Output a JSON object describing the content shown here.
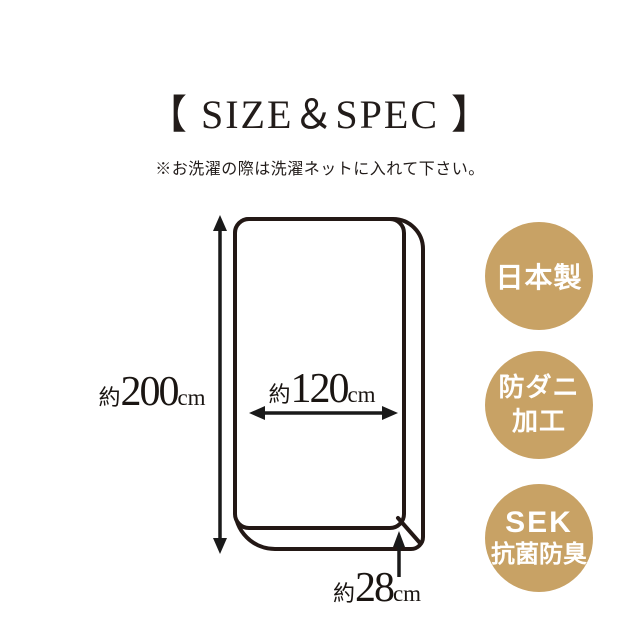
{
  "page": {
    "title": "【 SIZE＆SPEC 】",
    "note": "※お洗濯の際は洗濯ネットに入れて下さい。"
  },
  "diagram": {
    "subject": "fitted-sheet-outline",
    "line_color": "#231815",
    "arrow_color": "#1a1a1a",
    "dimensions": {
      "length": {
        "prefix": "約",
        "value": "200",
        "unit": "cm"
      },
      "width": {
        "prefix": "約",
        "value": "120",
        "unit": "cm"
      },
      "depth": {
        "prefix": "約",
        "value": "28",
        "unit": "cm"
      }
    }
  },
  "badges": {
    "color": "#C8A265",
    "text_color": "#FFFFFF",
    "items": [
      {
        "lines": [
          "日本製"
        ]
      },
      {
        "lines": [
          "防ダニ",
          "加工"
        ]
      },
      {
        "lines": [
          "SEK",
          "抗菌防臭"
        ]
      }
    ]
  }
}
